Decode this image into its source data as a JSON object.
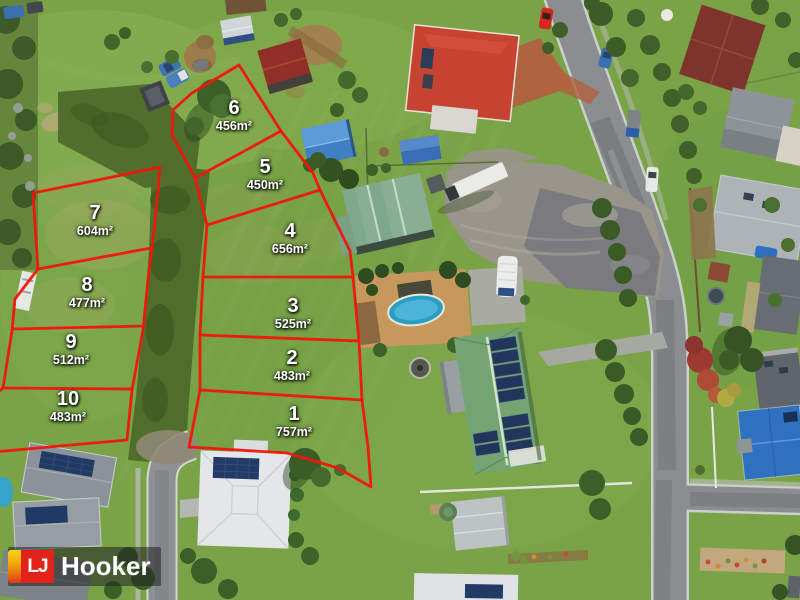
{
  "lots": [
    {
      "number": "1",
      "area": "757m²"
    },
    {
      "number": "2",
      "area": "483m²"
    },
    {
      "number": "3",
      "area": "525m²"
    },
    {
      "number": "4",
      "area": "656m²"
    },
    {
      "number": "5",
      "area": "450m²"
    },
    {
      "number": "6",
      "area": "456m²"
    },
    {
      "number": "7",
      "area": "604m²"
    },
    {
      "number": "8",
      "area": "477m²"
    },
    {
      "number": "9",
      "area": "512m²"
    },
    {
      "number": "10",
      "area": "483m²"
    }
  ],
  "watermark": {
    "monogram": "LJ",
    "brand": "Hooker",
    "brand_red": "#e2231a",
    "stripe_gradient_top": "#f9d616",
    "stripe_gradient_bottom": "#e03a18",
    "band_color": "rgba(33,33,33,0.55)"
  },
  "overlay": {
    "boundary_color": "#f2150a",
    "label_color": "#ffffff"
  }
}
